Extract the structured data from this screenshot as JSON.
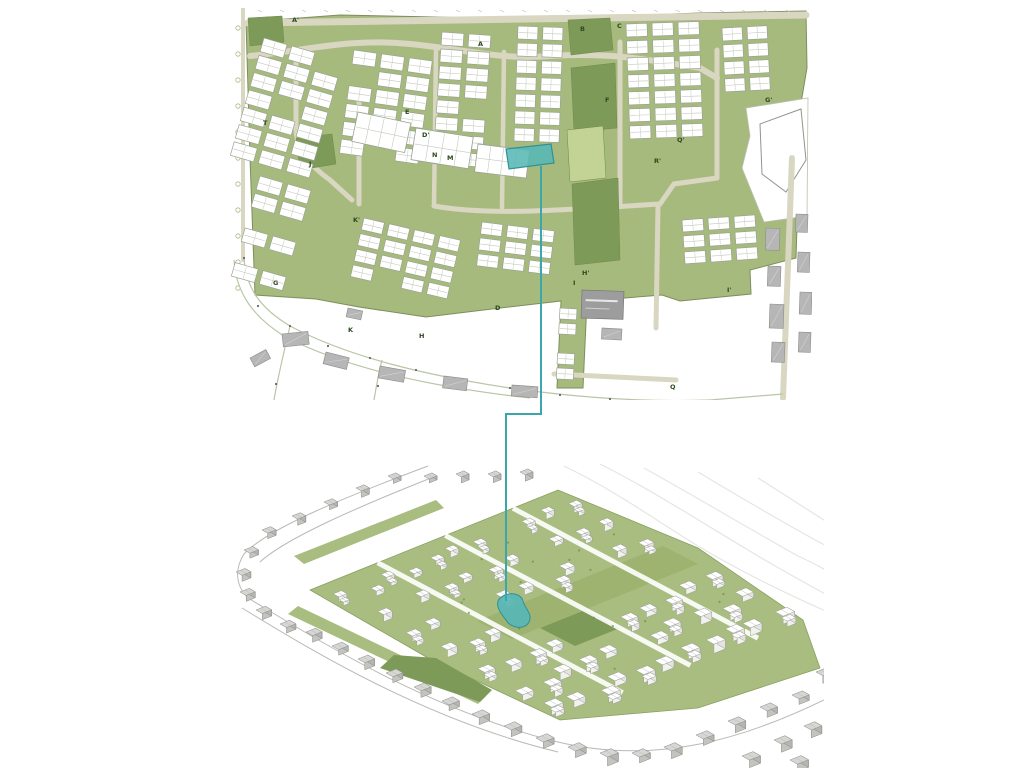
{
  "figure": {
    "description": "Urban masterplan drawing: 2D site plan above, 3D axonometric massing view below, linked by a teal leader line highlighting a small water basin"
  },
  "palette": {
    "background": "#ffffff",
    "site_green": "#a7ba7d",
    "site_green_3d": "#a9bd80",
    "park_dark": "#7e9a58",
    "lawn_light": "#c3d395",
    "road_beige": "#d9d6c2",
    "street_line": "#b9c6a6",
    "building_white": "#ffffff",
    "building_stroke": "#9aa392",
    "building_inner": "#c4c8bd",
    "existing_gray": "#b6b6b6",
    "existing_gray_dark": "#9d9d9d",
    "gray3d_top": "#d6d6d4",
    "gray3d_front": "#c3c3c0",
    "gray3d_side": "#b5b5b2",
    "white3d_front": "#f1f1ee",
    "white3d_side": "#e4e4e0",
    "line_gray": "#8b8b88",
    "contour": "#e6e6e1",
    "label_green": "#2c4a1e",
    "teal_line": "#3aa7ad",
    "teal_fill": "#58b7b5",
    "teal_stroke": "#2f9097"
  },
  "plan2d": {
    "labels": [
      {
        "text": "A'",
        "x": 62,
        "y": 14
      },
      {
        "text": "A",
        "x": 248,
        "y": 38
      },
      {
        "text": "B",
        "x": 350,
        "y": 23
      },
      {
        "text": "C",
        "x": 387,
        "y": 20
      },
      {
        "text": "G'",
        "x": 535,
        "y": 94
      },
      {
        "text": "F",
        "x": 375,
        "y": 94
      },
      {
        "text": "E",
        "x": 175,
        "y": 106
      },
      {
        "text": "D'",
        "x": 192,
        "y": 129
      },
      {
        "text": "N",
        "x": 202,
        "y": 149
      },
      {
        "text": "M",
        "x": 217,
        "y": 152
      },
      {
        "text": "T",
        "x": 33,
        "y": 117
      },
      {
        "text": "J",
        "x": 79,
        "y": 158
      },
      {
        "text": "K'",
        "x": 123,
        "y": 214
      },
      {
        "text": "G",
        "x": 43,
        "y": 277
      },
      {
        "text": "D",
        "x": 265,
        "y": 302
      },
      {
        "text": "K",
        "x": 118,
        "y": 324
      },
      {
        "text": "H",
        "x": 189,
        "y": 330
      },
      {
        "text": "H'",
        "x": 352,
        "y": 267
      },
      {
        "text": "I",
        "x": 343,
        "y": 277
      },
      {
        "text": "I'",
        "x": 497,
        "y": 284
      },
      {
        "text": "Q'",
        "x": 447,
        "y": 134
      },
      {
        "text": "R'",
        "x": 424,
        "y": 155
      },
      {
        "text": "Q",
        "x": 440,
        "y": 381
      }
    ],
    "pond_points": "276,141 321,136 324,155 279,161"
  },
  "view3d": {
    "pond_path": "M272,136 C280,129 293,131 295,139 C297,147 305,152 301,160 C297,168 283,167 278,158 C272,151 266,142 272,136 Z"
  },
  "connector": {
    "points": [
      [
        541,
        166
      ],
      [
        541,
        414
      ],
      [
        506,
        414
      ],
      [
        506,
        601
      ]
    ]
  }
}
